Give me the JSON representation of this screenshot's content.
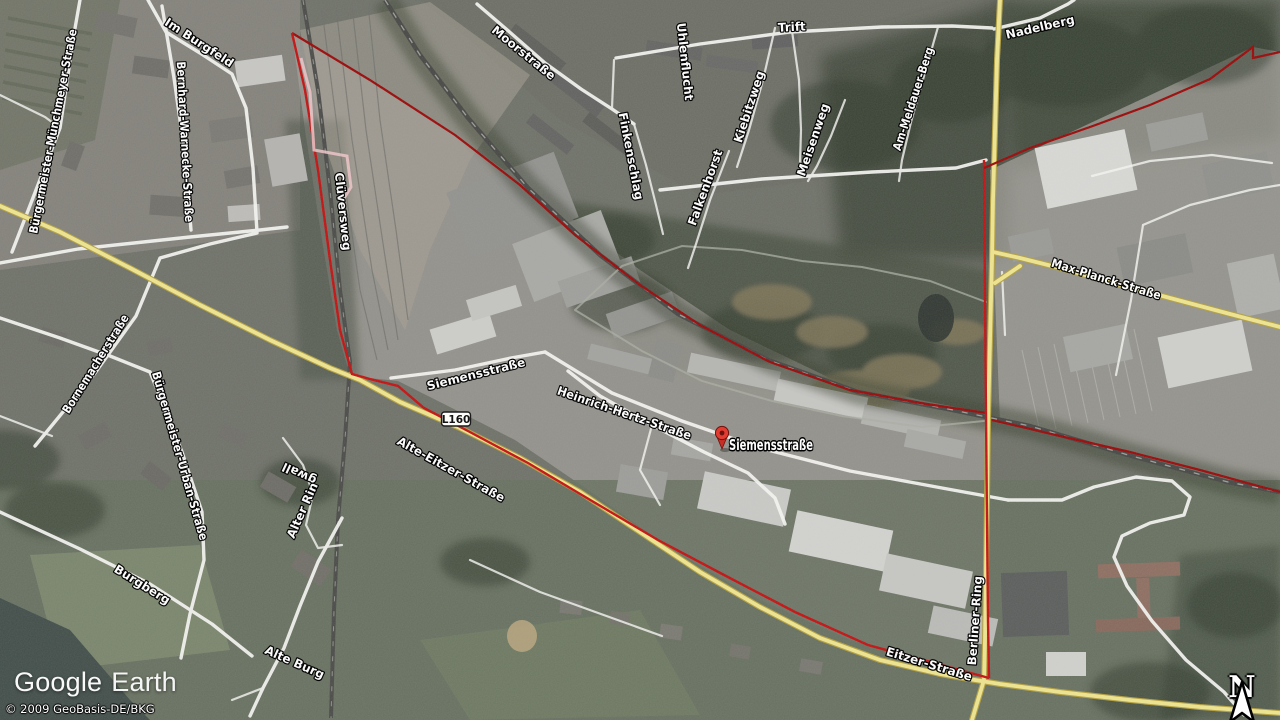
{
  "app": {
    "logo": {
      "word1": "Google",
      "word2": "Earth"
    },
    "copyright": "© 2009 GeoBasis-DE/BKG",
    "compass": {
      "letter": "N"
    }
  },
  "placemark": {
    "label": "Siemensstraße",
    "x": 722,
    "y": 433
  },
  "road_shield": {
    "label": "L160",
    "x": 456,
    "y": 419
  },
  "colors": {
    "road_major_fill": "#efe58f",
    "road_major_casing": "#b3a03f",
    "boundary_dark": "#9b0606",
    "boundary_bright": "#c40f0f",
    "street_road": "#f6f6f3",
    "label_fill": "#ffffff",
    "label_outline": "#000000",
    "survey_line": "#f0c6c9",
    "pin_red": "#e03c31"
  },
  "street_labels": [
    {
      "text": "Bürgermeister-Münchmeyer-Straße",
      "x": 57,
      "y": 132,
      "rot": -79
    },
    {
      "text": "Im Burgfeld",
      "x": 197,
      "y": 46,
      "rot": 33
    },
    {
      "text": "Bernhard-Warnecke-Straße",
      "x": 181,
      "y": 142,
      "rot": 87
    },
    {
      "text": "Moorstraße",
      "x": 521,
      "y": 56,
      "rot": 39
    },
    {
      "text": "Finkenschlag",
      "x": 627,
      "y": 157,
      "rot": 79
    },
    {
      "text": "Uhlenflucht",
      "x": 681,
      "y": 62,
      "rot": 84
    },
    {
      "text": "Falkenhorst",
      "x": 709,
      "y": 189,
      "rot": -70
    },
    {
      "text": "Kiebitzweg",
      "x": 753,
      "y": 108,
      "rot": -72
    },
    {
      "text": "Trift",
      "x": 792,
      "y": 31,
      "rot": -3
    },
    {
      "text": "Meisenweg",
      "x": 817,
      "y": 141,
      "rot": -71
    },
    {
      "text": "Am-Meldauer-Berg",
      "x": 917,
      "y": 100,
      "rot": -72
    },
    {
      "text": "Nadelberg",
      "x": 1041,
      "y": 31,
      "rot": -13
    },
    {
      "text": "Clüversweg",
      "x": 339,
      "y": 212,
      "rot": 84
    },
    {
      "text": "Bornemacherstraße",
      "x": 99,
      "y": 366,
      "rot": -58
    },
    {
      "text": "Bürgermeister-Urban-Straße",
      "x": 176,
      "y": 457,
      "rot": 74
    },
    {
      "text": "Alter Rin",
      "x": 306,
      "y": 512,
      "rot": -66
    },
    {
      "text": "gwall",
      "x": 301,
      "y": 470,
      "rot": -155
    },
    {
      "text": "Siemensstraße",
      "x": 477,
      "y": 378,
      "rot": -14
    },
    {
      "text": "Heinrich-Hertz-Straße",
      "x": 623,
      "y": 417,
      "rot": 19
    },
    {
      "text": "Alte-Eitzer-Straße",
      "x": 449,
      "y": 473,
      "rot": 29
    },
    {
      "text": "Max-Planck-Straße",
      "x": 1105,
      "y": 283,
      "rot": 17
    },
    {
      "text": "Berliner-Ring",
      "x": 979,
      "y": 621,
      "rot": -86
    },
    {
      "text": "Eitzer-Straße",
      "x": 928,
      "y": 668,
      "rot": 17
    },
    {
      "text": "Burgberg",
      "x": 140,
      "y": 588,
      "rot": 32
    },
    {
      "text": "Alte Burg",
      "x": 293,
      "y": 666,
      "rot": 24
    }
  ]
}
